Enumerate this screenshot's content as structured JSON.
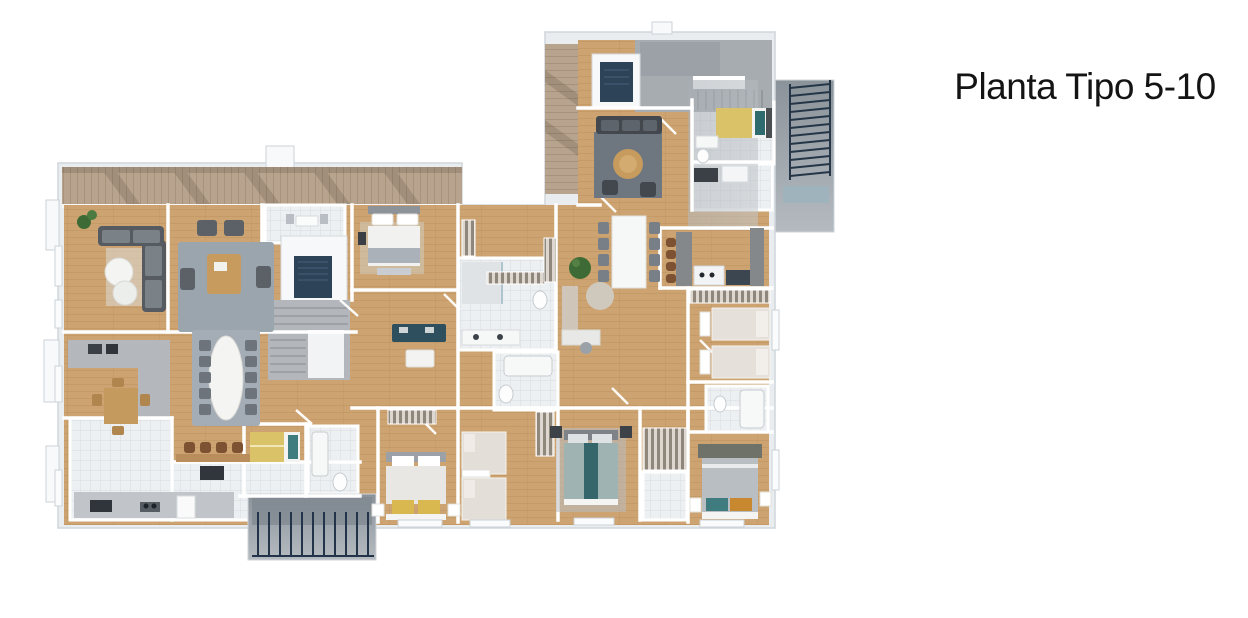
{
  "page": {
    "background": "#ffffff"
  },
  "title": {
    "text": "Planta Tipo 5-10",
    "color": "#141414"
  },
  "floorplan": {
    "type": "architectural-floorplan-3d-render",
    "floors_shown": "5-10",
    "palette": {
      "wood_floor": "#cda471",
      "deck_wood": "#b8a48e",
      "tile": "#edf0f2",
      "stone_floor": "#b9bdc1",
      "concrete_terrace": "#9aa1a7",
      "slab": "#e9edf0",
      "wall": "#ffffff",
      "elevator_navy": "#2c4358",
      "stairs_gray": "#b3b7bc",
      "sofa_gray": "#4a5055",
      "rug_gray": "#9aa5ad",
      "bed_white": "#f1f1ef",
      "bed_yellow": "#d9c267",
      "bed_teal": "#3e7d80",
      "accent_orange": "#c8882f",
      "marble_white": "#f4f4f2",
      "wood_furniture": "#c79a5e",
      "plant_green": "#3e6b35",
      "railing_dark": "#27384a"
    }
  }
}
